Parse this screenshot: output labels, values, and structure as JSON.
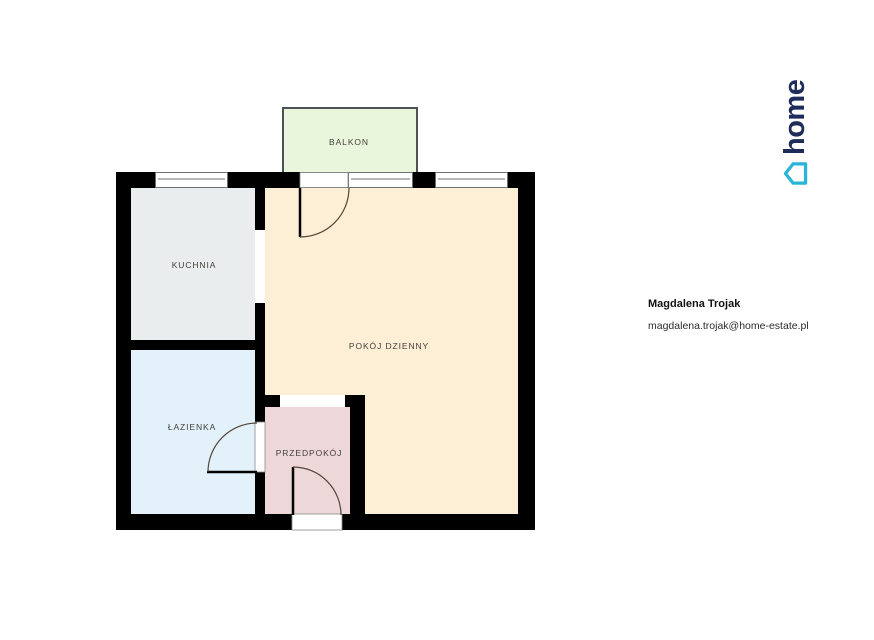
{
  "floor_plan": {
    "rooms": [
      {
        "id": "balkon",
        "label": "BALKON",
        "color": "#eaf6dc"
      },
      {
        "id": "kuchnia",
        "label": "KUCHNIA",
        "color": "#e9edee"
      },
      {
        "id": "lazienka",
        "label": "ŁAZIENKA",
        "color": "#e3f1fb"
      },
      {
        "id": "pokoj-dzienny",
        "label": "POKÓJ DZIENNY",
        "color": "#fdeed6"
      },
      {
        "id": "przedpokoj",
        "label": "PRZEDPOKÓJ",
        "color": "#eed7d9"
      }
    ],
    "wall_color": "#000000",
    "balcony_border_color": "#4e5256",
    "window_frame_color": "#6f6f6f",
    "door_arc_color": "#514538"
  },
  "agent": {
    "name": "Magdalena Trojak",
    "email": "magdalena.trojak@home-estate.pl"
  },
  "logo": {
    "text": "home",
    "text_color": "#1e2c5a",
    "icon_color": "#29b5d8"
  }
}
